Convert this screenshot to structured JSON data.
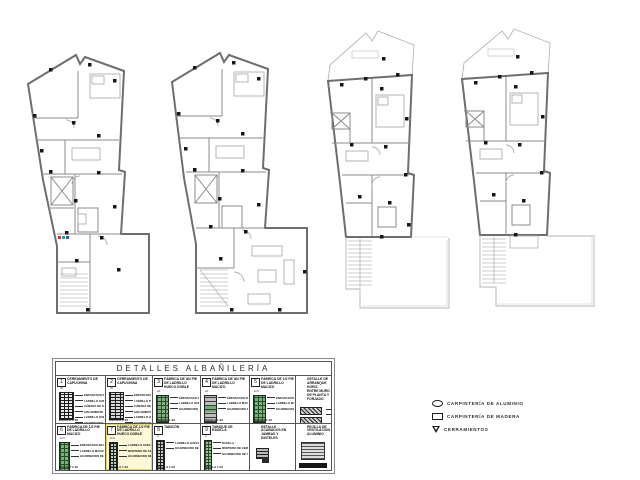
{
  "details": {
    "title": "DETALLES  ALBAÑILERÍA",
    "cells": [
      {
        "row": 1,
        "w": 0,
        "number": "1",
        "title": "CERRAMIENTO DE CAPUCHINA",
        "dim": "29",
        "art": "art-capuchina",
        "highlight": false,
        "labels": [
          "ENFOSCADO DE MORTERO 1:6",
          "LADRILLO HUECO SENCILLO",
          "CÁMARA DE AIRE",
          "AISLAMIENTO TÉRMICO",
          "LADRILLO HUECO DOBLE",
          "GUARNECIDO DE YESO"
        ],
        "scale": "ESCALA 1:10"
      },
      {
        "row": 1,
        "w": 1,
        "number": "2",
        "title": "CERRAMIENTO DE CAPUCHINA",
        "dim": "29",
        "art": "art-capuchina2",
        "highlight": false,
        "labels": [
          "ENFOSCADO DE MORTERO 1:6",
          "LADRILLO PERFORADO VISTO",
          "CÁMARA DE AIRE",
          "AISLAMIENTO TÉRMICO",
          "LADRILLO HUECO DOBLE",
          "GUARNECIDO DE YESO"
        ],
        "scale": "ESCALA 1:10"
      },
      {
        "row": 1,
        "w": 2,
        "number": "3",
        "title": "FÁBRICA DE UN PIE DE LADRILLO HUECO DOBLE",
        "dim": "24",
        "art": "art-brick-green",
        "highlight": false,
        "labels": [
          "ENFOSCADO DE MORTERO 1:6",
          "LADRILLO HUECO DOBLE",
          "GUARNECIDO DE YESO"
        ],
        "scale": "ESCALA 1:10"
      },
      {
        "row": 1,
        "w": 3,
        "number": "4",
        "title": "FÁBRICA DE UN PIE DE LADRILLO MACIZO",
        "dim": "24",
        "art": "art-brick-gray",
        "highlight": false,
        "labels": [
          "ENFOSCADO DE MORTERO 1:6",
          "LADRILLO MACIZO",
          "GUARNECIDO DE YESO"
        ],
        "scale": "ESCALA 1:10"
      },
      {
        "row": 1,
        "w": 4,
        "number": "5",
        "title": "FÁBRICA DE 1/2 PIE DE LADRILLO MACIZO",
        "dim": "11.5",
        "art": "art-brick-green",
        "highlight": false,
        "labels": [
          "ENFOSCADO DE MORTERO 1:6",
          "LADRILLO MACIZO",
          "GUARNECIDO DE YESO"
        ],
        "scale": "ESCALA 1:10"
      },
      {
        "row": 1,
        "w": 5,
        "number": "",
        "title": "DETALLE DE ARRANQUE HORIZ. ENTRE MURO DE PLANTA Y FORJADO",
        "dim": "",
        "art": "art-anchor",
        "highlight": false,
        "labels": [
          "MURO DE CARGA",
          "FORJADO"
        ],
        "scale": ""
      },
      {
        "row": 2,
        "w": 0,
        "number": "6",
        "title": "FÁBRICA DE 1/2 PIE DE LADRILLO MACIZO",
        "dim": "11.5",
        "art": "art-brick-tall-green",
        "highlight": false,
        "labels": [
          "ENFOSCADO DE MORTERO 1:6",
          "LADRILLO MACIZO",
          "GUARNECIDO DE YESO"
        ],
        "scale": "ESCALA 1:10"
      },
      {
        "row": 2,
        "w": 1,
        "number": "7",
        "title": "FÁBRICA DE 1/2 PIE DE LADRILLO HUECO DOBLE",
        "dim": "11.5",
        "art": "art-tabicon",
        "highlight": true,
        "labels": [
          "LADRILLO HUECO DOBLE",
          "MORTERO DE CEMENTO",
          "GUARNECIDO DE YESO"
        ],
        "scale": "ESCALA 1:10"
      },
      {
        "row": 2,
        "w": 2,
        "number": "8",
        "title": "TABICÓN",
        "dim": "9",
        "art": "art-tabicon",
        "highlight": false,
        "labels": [
          "LADRILLO HUECO DOBLE",
          "GUARNECIDO DE YESO"
        ],
        "scale": "ESCALA 1:10"
      },
      {
        "row": 2,
        "w": 3,
        "number": "9",
        "title": "TABIQUE DE RASILLA",
        "dim": "4",
        "art": "art-rasilla",
        "highlight": false,
        "labels": [
          "RASILLA",
          "MORTERO DE CEMENTO",
          "GUARNECIDO DE YESO"
        ],
        "scale": "ESCALA 1:10"
      },
      {
        "row": 2,
        "w": 4,
        "number": "",
        "title": "DETALLE ACABADOS EN JAMBAS Y DINTELES",
        "dim": "",
        "art": "art-jambs",
        "highlight": false,
        "labels": [],
        "scale": ""
      },
      {
        "row": 2,
        "w": 5,
        "number": "",
        "title": "REJILLA DE VENTILACIÓN ALUMINIO",
        "dim": "",
        "art": "art-grille",
        "highlight": false,
        "labels": [],
        "scale": ""
      }
    ]
  },
  "legend": {
    "items": [
      {
        "icon": "oval-icon",
        "label": "CARPINTERÍA  DE  ALUMINIO"
      },
      {
        "icon": "rect-icon",
        "label": "CARPINTERÍA  DE  MADERA"
      },
      {
        "icon": "triangle-icon",
        "label": "CERRAMIENTOS"
      }
    ]
  },
  "colors": {
    "wall": "#6e6e6e",
    "thin_line": "#b4b4b4",
    "marker": "#161616",
    "brick_green": "#7fae7f",
    "highlight": "#fdf9d8"
  }
}
